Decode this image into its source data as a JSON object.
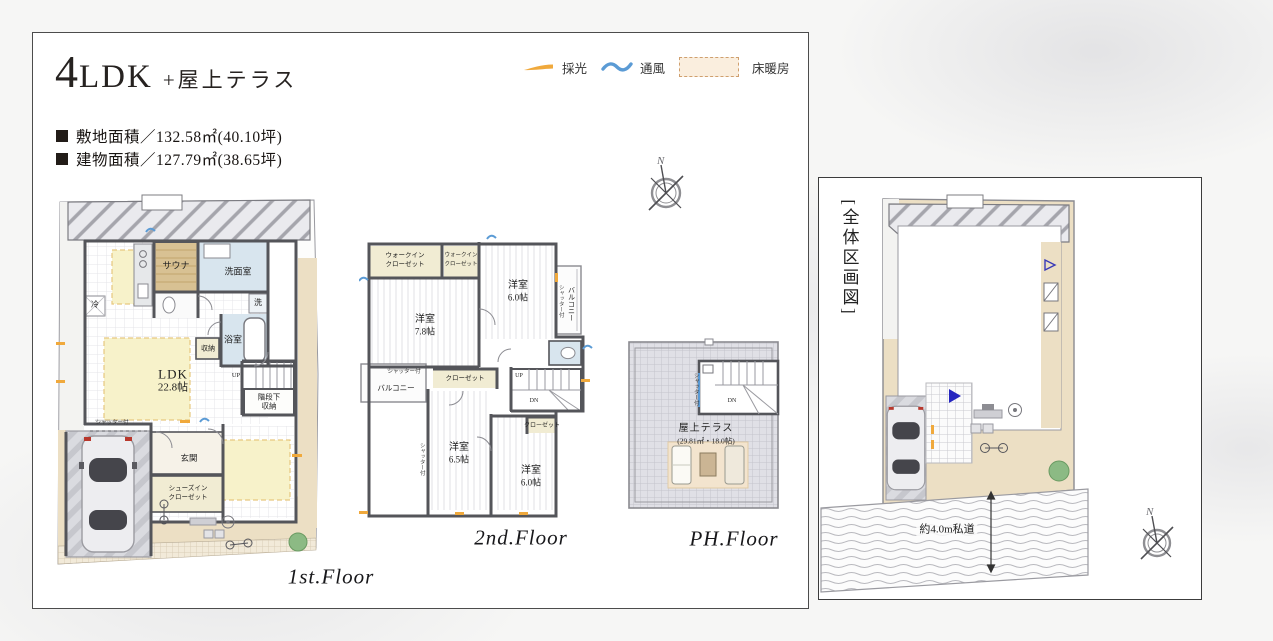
{
  "header": {
    "title_main_4": "4",
    "title_main_ldk": "LDK",
    "title_sub": "+屋上テラス",
    "site_area": "敷地面積／132.58㎡(40.10坪)",
    "building_area": "建物面積／127.79㎡(38.65坪)"
  },
  "legend": {
    "daylight": "採光",
    "ventilation": "通風",
    "floor_heating": "床暖房"
  },
  "colors": {
    "daylight_accent": "#f0a93c",
    "ventilation_accent": "#5b9bd5",
    "floor_heating_fill": "#faeede",
    "wall": "#54555a",
    "ground_beige": "#ecdfc4"
  },
  "floor1": {
    "name": "1st.Floor",
    "labels": {
      "fridge": "冷",
      "sauna": "サウナ",
      "washroom": "洗面室",
      "washer": "洗",
      "bathroom": "浴室",
      "storage": "収納",
      "ldk": "LDK",
      "ldk_size": "22.8帖",
      "up": "UP",
      "stair_storage_1": "階段下",
      "stair_storage_2": "収納",
      "entrance": "玄関",
      "shoe_closet_1": "シューズイン",
      "shoe_closet_2": "クローゼット",
      "shutter": "シャッター付"
    }
  },
  "floor2": {
    "name": "2nd.Floor",
    "labels": {
      "wic_1": "ウォークイン",
      "wic_2": "クローゼット",
      "room": "洋室",
      "size_a": "7.8帖",
      "size_b": "6.0帖",
      "size_c": "6.5帖",
      "size_d": "6.0帖",
      "closet": "クローゼット",
      "balcony": "バルコニー",
      "shutter": "シャッター付",
      "up": "UP",
      "dn": "DN"
    }
  },
  "floor_ph": {
    "name": "PH.Floor",
    "labels": {
      "terrace": "屋上テラス",
      "terrace_size": "(29.81㎡・18.0帖)",
      "shutter": "シャッター付",
      "dn": "DN"
    }
  },
  "site_plan": {
    "title": "[全体区画図]",
    "road": "約4.0m私道"
  },
  "compass": {
    "north": "N"
  }
}
